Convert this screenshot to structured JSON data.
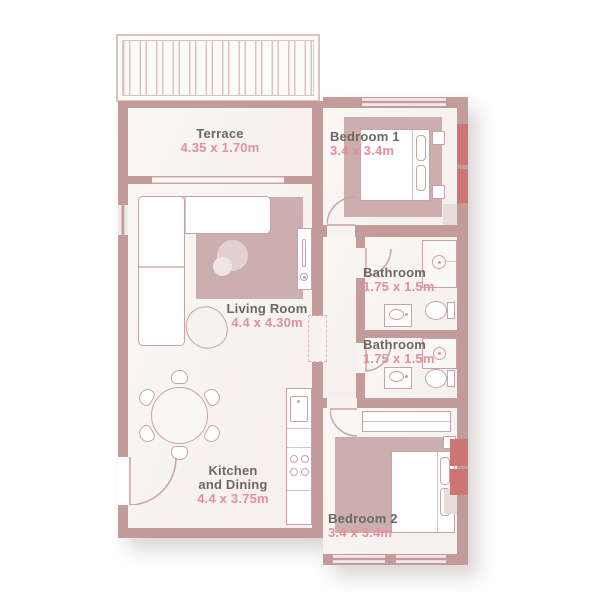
{
  "colors": {
    "wall": "#c39b9b",
    "wall_accent": "#cb7575",
    "room_fill": "#f7f3f1",
    "rug": "#ccaeae",
    "furniture_outline": "#c9a3a3",
    "room_name_text": "#6c6866",
    "dimension_text": "#e2909c"
  },
  "rooms": [
    {
      "id": "terrace",
      "name": "Terrace",
      "dims": "4.35 x 1.70m"
    },
    {
      "id": "bedroom-1",
      "name": "Bedroom 1",
      "dims": "3.4 x 3.4m"
    },
    {
      "id": "living-room",
      "name": "Living Room",
      "dims": "4.4 x 4.30m"
    },
    {
      "id": "bathroom-1",
      "name": "Bathroom",
      "dims": "1.75 x 1.5m"
    },
    {
      "id": "bathroom-2",
      "name": "Bathroom",
      "dims": "1.75 x 1.5m"
    },
    {
      "id": "kitchen-dining",
      "name": "Kitchen and Dining",
      "name_lines": [
        "Kitchen",
        "and Dining"
      ],
      "dims": "4.4 x 3.75m"
    },
    {
      "id": "bedroom-2",
      "name": "Bedroom 2",
      "dims": "3.4 x 3.4m"
    }
  ],
  "furniture_icons": [
    "terrace-pergola",
    "sliding-door",
    "entry-door",
    "interior-door",
    "window",
    "sofa",
    "coffee-table",
    "armchair",
    "tv-unit",
    "dining-table",
    "dining-chair",
    "kitchen-counter",
    "kitchen-sink",
    "stove",
    "bed",
    "pillow",
    "nightstand",
    "wardrobe",
    "closet",
    "shower",
    "toilet",
    "washbasin",
    "rug"
  ]
}
